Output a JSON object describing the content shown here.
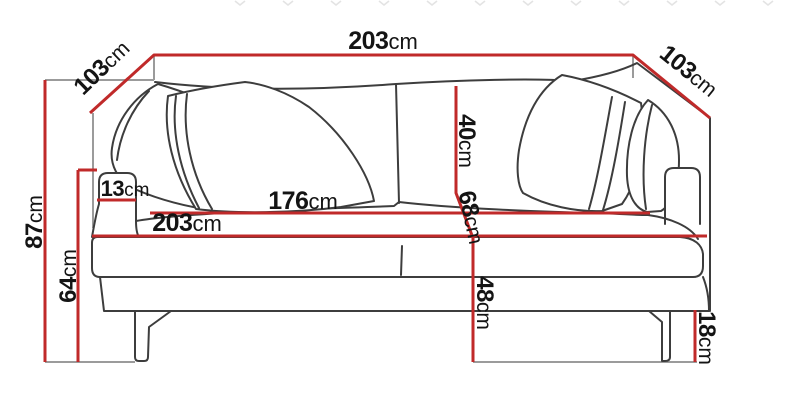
{
  "title": "Sofa dimension diagram",
  "colors": {
    "dimension_line": "#c02a2a",
    "sofa_outline": "#3d3d3d",
    "helper_line": "#9b9b9b",
    "label_text": "#141414",
    "background": "#ffffff",
    "watermark": "#e3e3e3"
  },
  "dimensions": {
    "total_width": {
      "value": "203",
      "unit": "cm"
    },
    "depth_left": {
      "value": "103",
      "unit": "cm"
    },
    "depth_right": {
      "value": "103",
      "unit": "cm"
    },
    "total_height": {
      "value": "87",
      "unit": "cm"
    },
    "arm_height": {
      "value": "64",
      "unit": "cm"
    },
    "arm_width": {
      "value": "13",
      "unit": "cm"
    },
    "seat_width": {
      "value": "176",
      "unit": "cm"
    },
    "base_width": {
      "value": "203",
      "unit": "cm"
    },
    "back_cushion_height": {
      "value": "40",
      "unit": "cm"
    },
    "seat_depth": {
      "value": "68",
      "unit": "cm"
    },
    "seat_height": {
      "value": "48",
      "unit": "cm"
    },
    "leg_height": {
      "value": "18",
      "unit": "cm"
    }
  }
}
